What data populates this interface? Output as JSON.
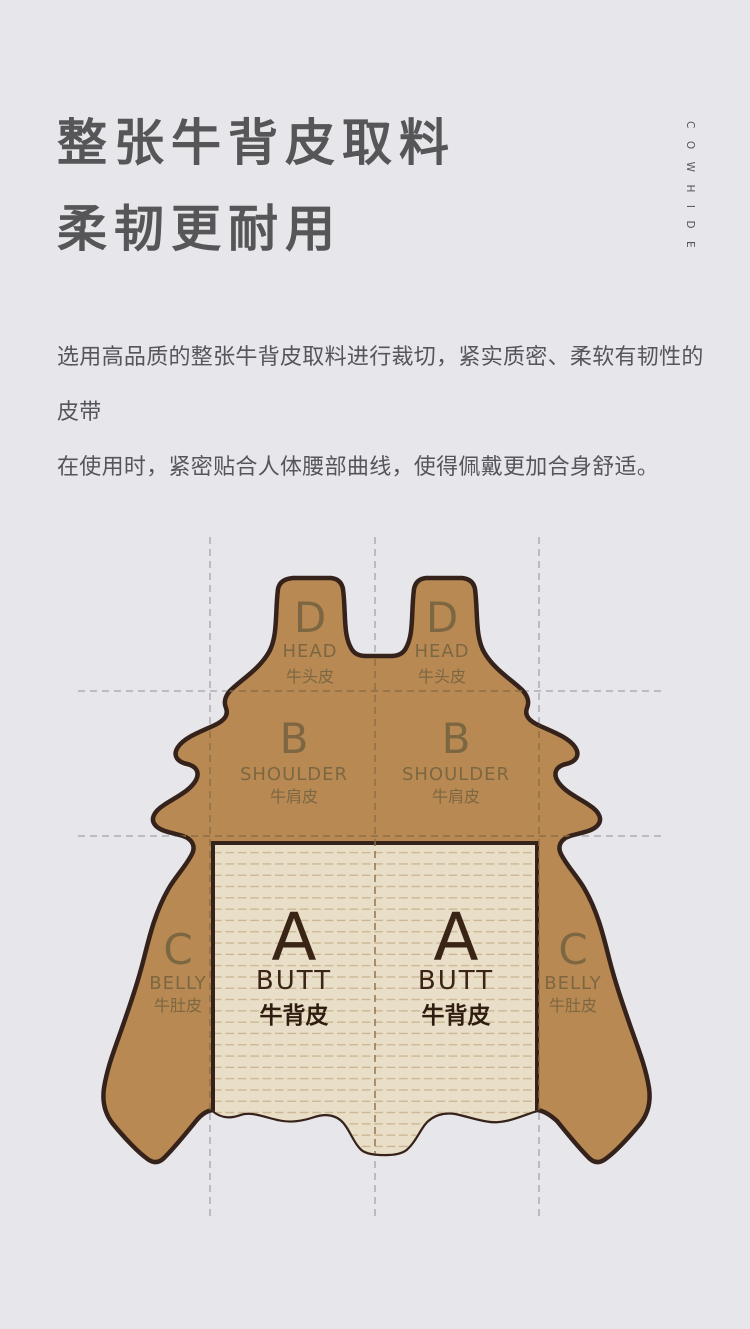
{
  "page": {
    "background": "#e7e7eb"
  },
  "header": {
    "title_lines": [
      "整张牛背皮取料",
      "柔韧更耐用"
    ],
    "vertical_label": "COWHIDE",
    "description_lines": [
      "选用高品质的整张牛背皮取料进行裁切，紧实质密、柔软有韧性的皮带",
      "在使用时，紧密贴合人体腰部曲线，使得佩戴更加合身舒适。"
    ]
  },
  "diagram": {
    "regions": [
      {
        "letter": "A",
        "en": "BUTT",
        "zh": "牛背皮"
      },
      {
        "letter": "B",
        "en": "SHOULDER",
        "zh": "牛肩皮"
      },
      {
        "letter": "C",
        "en": "BELLY",
        "zh": "牛肚皮"
      },
      {
        "letter": "D",
        "en": "HEAD",
        "zh": "牛头皮"
      }
    ],
    "colors": {
      "hide_fill": "#b88952",
      "hide_outline": "#35221a",
      "butt_panel_fill": "#e9dec7",
      "butt_panel_stripe": "#c9b592",
      "region_label": "#7d6742",
      "butt_label": "#3a2415",
      "guide_gray": "#a3a3a9",
      "guide_brown": "#8d6d46"
    }
  },
  "text_colors": {
    "title": "#565659",
    "body": "#55555a",
    "background": "#e7e7eb"
  }
}
